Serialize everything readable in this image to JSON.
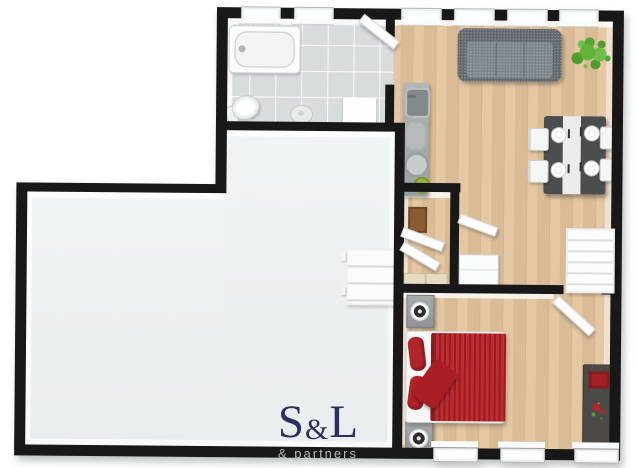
{
  "document": {
    "kind": "3D floor plan render",
    "background": "#ffffff"
  },
  "logo": {
    "s": "S",
    "amp": "&",
    "l": "L",
    "sub": "& partners",
    "main_color": "#2c3060",
    "sub_color": "#b6b8ba"
  },
  "palette": {
    "wall": "#181818",
    "wood_floor": "#e2c49c",
    "tile_floor": "#d9dcdd",
    "light_floor": "#eef1f1",
    "sofa_gray": "#6f747b",
    "bed_red": "#b2232a",
    "table_dark": "#4b4d4f",
    "counter_gray": "#a7abac",
    "plant_green": "#63b23a",
    "furniture_white": "#f7f8f8"
  },
  "rooms": [
    {
      "id": "bathroom",
      "floor": "tile",
      "fixtures": [
        "bathtub",
        "toilet",
        "floor-drain",
        "shower-mat",
        "open-door",
        "2-windows"
      ]
    },
    {
      "id": "kitchen-living-room",
      "floor": "wood",
      "fixtures": [
        "kitchen-counter-with-sink",
        "gray-sofa",
        "potted-plant",
        "dining-table-with-four-chairs",
        "4-windows"
      ]
    },
    {
      "id": "hallway-closets",
      "floor": "wood",
      "fixtures": [
        "brown-rug",
        "wardrobe-doors",
        "drawer-boxes",
        "white-dresser",
        "ladder-shelf"
      ]
    },
    {
      "id": "bedroom",
      "floor": "wood",
      "fixtures": [
        "red-double-bed",
        "nightstand-north",
        "nightstand-south",
        "dark-sideboard",
        "open-door",
        "3-windows"
      ]
    },
    {
      "id": "large-empty-room",
      "floor": "light",
      "fixtures": [
        "wall-mounted-shelf"
      ]
    }
  ],
  "openings": {
    "top_windows": 6,
    "bottom_windows": 3,
    "doors": 5
  }
}
